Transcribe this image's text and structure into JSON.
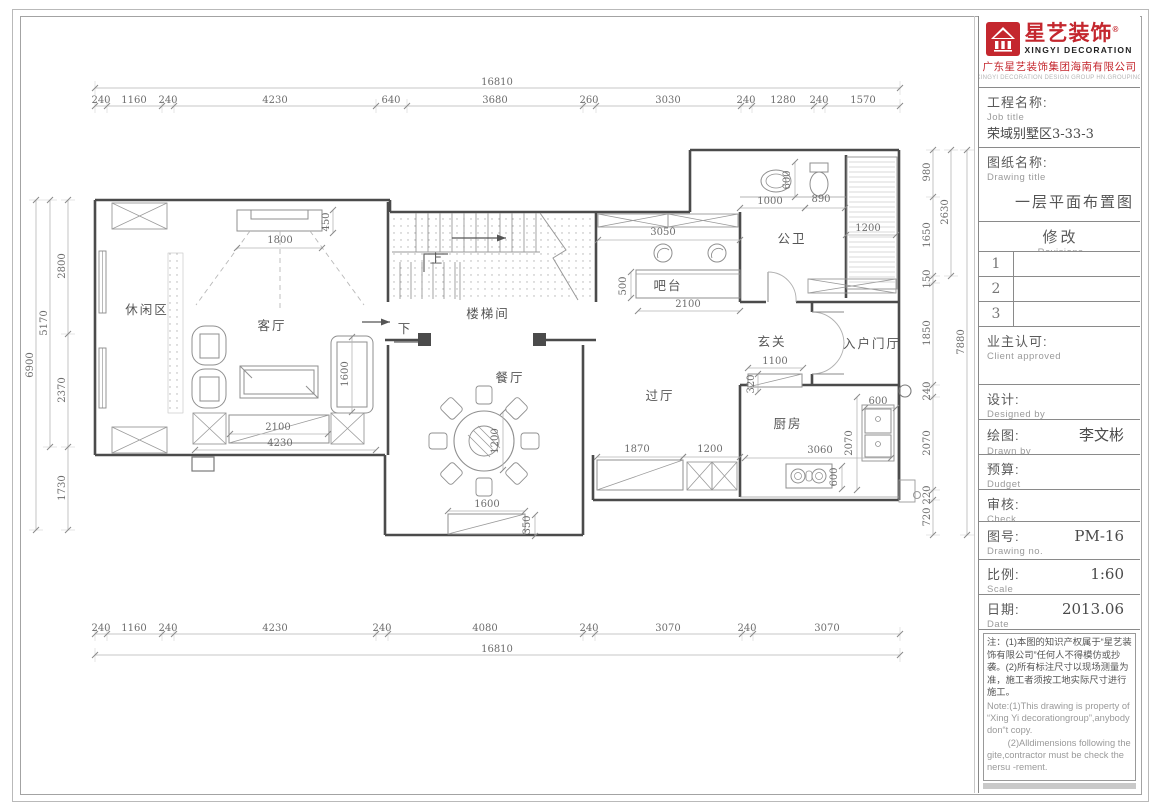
{
  "title_block": {
    "brand": {
      "name": "星艺装饰",
      "reg": "®",
      "name_en": "XINGYI DECORATION",
      "company": "广东星艺装饰集团海南有限公司",
      "company_en": "XINGYI DECORATION DESIGN GROUP HN.GROUPING"
    },
    "job": {
      "label": "工程名称:",
      "label_en": "Job title",
      "value": "荣域别墅区3-33-3"
    },
    "drawing": {
      "label": "图纸名称:",
      "label_en": "Drawing title",
      "value": "一层平面布置图"
    },
    "revisions": {
      "label": "修改",
      "label_en": "Revisions",
      "rows": [
        "1",
        "2",
        "3"
      ]
    },
    "client": {
      "label": "业主认可:",
      "label_en": "Client approved",
      "value": ""
    },
    "designed": {
      "label": "设计:",
      "label_en": "Designed by",
      "value": ""
    },
    "drawn": {
      "label": "绘图:",
      "label_en": "Drawn by",
      "value": "李文彬"
    },
    "budget": {
      "label": "预算:",
      "label_en": "Dudget",
      "value": ""
    },
    "check": {
      "label": "审核:",
      "label_en": "Check",
      "value": ""
    },
    "drawing_no": {
      "label": "图号:",
      "label_en": "Drawing no.",
      "value": "PM-16"
    },
    "scale": {
      "label": "比例:",
      "label_en": "Scale",
      "value": "1:60"
    },
    "date": {
      "label": "日期:",
      "label_en": "Date",
      "value": "2013.06"
    },
    "notes": {
      "cn": "注：(1)本图的知识产权属于“星艺装饰有限公司”任何人不得模仿或抄袭。(2)所有标注尺寸以现场测量为准，施工者须按工地实际尺寸进行施工。",
      "en1": "Note:(1)This drawing is property of “Xing Yi decorationgroup”,anybody don“t copy.",
      "en2": "        (2)Alldimensions following the gite,contractor must be check the nersu -rement."
    }
  },
  "plan": {
    "rooms": [
      {
        "t": "休闲区",
        "x": 147,
        "y": 314
      },
      {
        "t": "客厅",
        "x": 272,
        "y": 330
      },
      {
        "t": "楼梯间",
        "x": 488,
        "y": 318
      },
      {
        "t": "餐厅",
        "x": 510,
        "y": 382
      },
      {
        "t": "过厅",
        "x": 660,
        "y": 400
      },
      {
        "t": "吧台",
        "x": 668,
        "y": 290
      },
      {
        "t": "公卫",
        "x": 792,
        "y": 243
      },
      {
        "t": "玄关",
        "x": 772,
        "y": 346
      },
      {
        "t": "入户门厅",
        "x": 872,
        "y": 348
      },
      {
        "t": "厨房",
        "x": 788,
        "y": 428
      },
      {
        "t": "上",
        "x": 437,
        "y": 263
      },
      {
        "t": "下",
        "x": 405,
        "y": 333
      }
    ],
    "dim_chains": [
      {
        "dir": "h",
        "pos": 88,
        "ticks": [
          95,
          900
        ],
        "labels": [
          {
            "t": "16810",
            "at": 497
          }
        ]
      },
      {
        "dir": "h",
        "pos": 106,
        "ticks": [
          95,
          107,
          162,
          174,
          376,
          407,
          583,
          596,
          741,
          752,
          814,
          825,
          900
        ],
        "labels": [
          {
            "t": "240",
            "at": 101
          },
          {
            "t": "1160",
            "at": 134
          },
          {
            "t": "240",
            "at": 168
          },
          {
            "t": "4230",
            "at": 275
          },
          {
            "t": "640",
            "at": 391
          },
          {
            "t": "3680",
            "at": 495
          },
          {
            "t": "260",
            "at": 589
          },
          {
            "t": "3030",
            "at": 668
          },
          {
            "t": "240",
            "at": 746
          },
          {
            "t": "1280",
            "at": 783
          },
          {
            "t": "240",
            "at": 819
          },
          {
            "t": "1570",
            "at": 863
          }
        ]
      },
      {
        "dir": "h",
        "pos": 634,
        "ticks": [
          95,
          107,
          162,
          174,
          376,
          388,
          583,
          595,
          742,
          753,
          900
        ],
        "labels": [
          {
            "t": "240",
            "at": 101
          },
          {
            "t": "1160",
            "at": 134
          },
          {
            "t": "240",
            "at": 168
          },
          {
            "t": "4230",
            "at": 275
          },
          {
            "t": "240",
            "at": 382
          },
          {
            "t": "4080",
            "at": 485
          },
          {
            "t": "240",
            "at": 589
          },
          {
            "t": "3070",
            "at": 668
          },
          {
            "t": "240",
            "at": 747
          },
          {
            "t": "3070",
            "at": 827
          }
        ]
      },
      {
        "dir": "h",
        "pos": 655,
        "ticks": [
          95,
          900
        ],
        "labels": [
          {
            "t": "16810",
            "at": 497
          }
        ]
      },
      {
        "dir": "v",
        "pos": 68,
        "ticks": [
          200,
          334,
          447,
          530
        ],
        "labels": [
          {
            "t": "2800",
            "at": 266
          },
          {
            "t": "2370",
            "at": 390
          },
          {
            "t": "1730",
            "at": 488
          }
        ]
      },
      {
        "dir": "v",
        "pos": 50,
        "ticks": [
          200,
          447
        ],
        "labels": [
          {
            "t": "5170",
            "at": 323
          }
        ]
      },
      {
        "dir": "v",
        "pos": 36,
        "ticks": [
          200,
          530
        ],
        "labels": [
          {
            "t": "6900",
            "at": 365
          }
        ]
      },
      {
        "dir": "v",
        "pos": 933,
        "ticks": [
          150,
          197,
          276,
          283,
          385,
          397,
          490,
          500,
          535
        ],
        "labels": [
          {
            "t": "980",
            "at": 172
          },
          {
            "t": "1650",
            "at": 235
          },
          {
            "t": "150",
            "at": 279
          },
          {
            "t": "1850",
            "at": 333
          },
          {
            "t": "240",
            "at": 391
          },
          {
            "t": "2070",
            "at": 443
          },
          {
            "t": "220",
            "at": 495
          },
          {
            "t": "720",
            "at": 517
          }
        ]
      },
      {
        "dir": "v",
        "pos": 951,
        "ticks": [
          150,
          276
        ],
        "labels": [
          {
            "t": "2630",
            "at": 212
          }
        ]
      },
      {
        "dir": "v",
        "pos": 967,
        "ticks": [
          150,
          535
        ],
        "labels": [
          {
            "t": "7880",
            "at": 342
          }
        ]
      }
    ],
    "inner_dims": [
      {
        "t": "1800",
        "x": 280,
        "y": 243,
        "line": [
          237,
          248,
          322,
          248
        ]
      },
      {
        "t": "450",
        "x": 329,
        "y": 222,
        "rot": -90,
        "line": [
          333,
          210,
          333,
          233
        ]
      },
      {
        "t": "1600",
        "x": 348,
        "y": 374,
        "rot": -90,
        "line": [
          352,
          337,
          352,
          412
        ]
      },
      {
        "t": "2100",
        "x": 278,
        "y": 430,
        "line": [
          230,
          434,
          328,
          434
        ]
      },
      {
        "t": "4230",
        "x": 280,
        "y": 446,
        "line": [
          195,
          450,
          376,
          450
        ]
      },
      {
        "t": "3050",
        "x": 663,
        "y": 235,
        "line": [
          598,
          240,
          740,
          240
        ]
      },
      {
        "t": "500",
        "x": 626,
        "y": 286,
        "rot": -90,
        "line": [
          631,
          272,
          631,
          298
        ]
      },
      {
        "t": "2100",
        "x": 688,
        "y": 307,
        "line": [
          638,
          311,
          740,
          311
        ]
      },
      {
        "t": "1000",
        "x": 770,
        "y": 204,
        "line": [
          740,
          208,
          805,
          208
        ]
      },
      {
        "t": "890",
        "x": 821,
        "y": 202,
        "line": [
          805,
          208,
          845,
          208
        ]
      },
      {
        "t": "600",
        "x": 790,
        "y": 180,
        "rot": -90,
        "line": [
          795,
          162,
          795,
          197
        ]
      },
      {
        "t": "1200",
        "x": 868,
        "y": 231,
        "line": [
          846,
          235,
          896,
          235
        ]
      },
      {
        "t": "1100",
        "x": 775,
        "y": 364,
        "line": [
          748,
          368,
          803,
          368
        ]
      },
      {
        "t": "320",
        "x": 754,
        "y": 384,
        "rot": -90,
        "line": [
          758,
          374,
          758,
          392
        ]
      },
      {
        "t": "1870",
        "x": 637,
        "y": 452,
        "line": [
          597,
          457,
          683,
          457
        ]
      },
      {
        "t": "1200",
        "x": 710,
        "y": 452,
        "line": [
          683,
          457,
          740,
          457
        ]
      },
      {
        "t": "3060",
        "x": 820,
        "y": 453,
        "line": [
          745,
          458,
          891,
          458
        ]
      },
      {
        "t": "2070",
        "x": 852,
        "y": 443,
        "rot": -90,
        "line": [
          857,
          397,
          857,
          490
        ]
      },
      {
        "t": "600",
        "x": 878,
        "y": 404,
        "line": [
          865,
          408,
          896,
          408
        ]
      },
      {
        "t": "600",
        "x": 837,
        "y": 477,
        "rot": -90,
        "line": [
          842,
          466,
          842,
          489
        ]
      },
      {
        "t": "1600",
        "x": 487,
        "y": 507,
        "line": [
          448,
          511,
          525,
          511
        ]
      },
      {
        "t": "350",
        "x": 530,
        "y": 525,
        "rot": -90,
        "line": [
          535,
          515,
          535,
          536
        ]
      },
      {
        "t": "1200",
        "x": 498,
        "y": 441,
        "rot": -90,
        "line": [
          503,
          412,
          503,
          470
        ]
      }
    ]
  }
}
